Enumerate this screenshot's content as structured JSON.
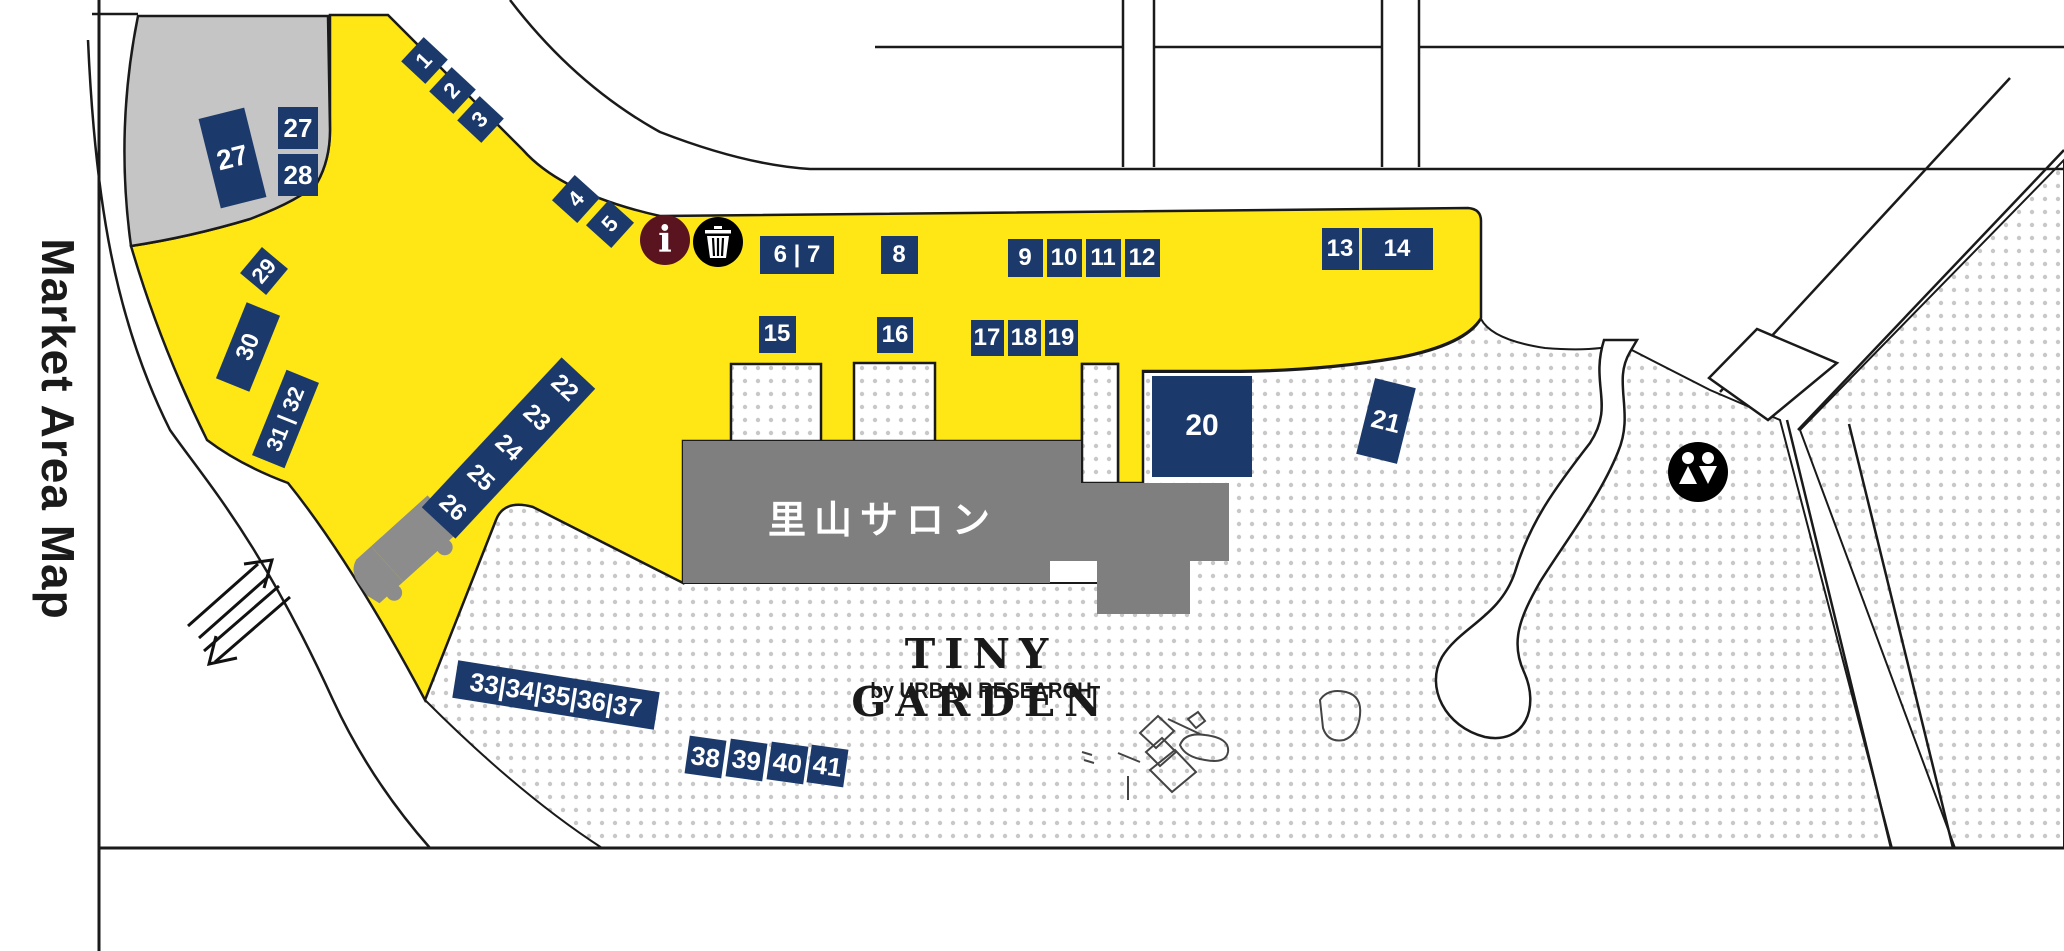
{
  "title": {
    "market_title": "Market Area Map"
  },
  "map": {
    "salon_label": "里山サロン",
    "brand": {
      "line1": "TINY GARDEN",
      "line2": "by URBAN RESEARCH"
    },
    "colors": {
      "market_yellow": "#ffe716",
      "badge_navy": "#1b3a6b",
      "parking_gray": "#c5c5c5",
      "building_gray": "#7f7f7f",
      "outline_black": "#1a1a1a",
      "dot_gray": "#c8c8c8",
      "info_maroon": "#5a1420"
    },
    "icons": {
      "info": {
        "glyph": "i",
        "x": 665,
        "y": 240,
        "r": 25
      },
      "trash": {
        "x": 718,
        "y": 242,
        "r": 25
      },
      "restroom": {
        "x": 1698,
        "y": 472,
        "r": 30
      }
    },
    "badges": [
      {
        "label": "1",
        "x": 424,
        "y": 60,
        "w": 33,
        "h": 33,
        "rot": 43,
        "trot": -90,
        "fs": 22
      },
      {
        "label": "2",
        "x": 452,
        "y": 90,
        "w": 33,
        "h": 33,
        "rot": 43,
        "trot": -90,
        "fs": 22
      },
      {
        "label": "3",
        "x": 480,
        "y": 119,
        "w": 33,
        "h": 33,
        "rot": 43,
        "trot": -90,
        "fs": 22
      },
      {
        "label": "4",
        "x": 576,
        "y": 199,
        "w": 34,
        "h": 34,
        "rot": 42,
        "trot": -90,
        "fs": 22
      },
      {
        "label": "5",
        "x": 610,
        "y": 224,
        "w": 34,
        "h": 34,
        "rot": 42,
        "trot": -90,
        "fs": 22
      },
      {
        "label": "6 | 7",
        "x": 797,
        "y": 255,
        "w": 74,
        "h": 38,
        "fs": 24
      },
      {
        "label": "8",
        "x": 899,
        "y": 255,
        "w": 37,
        "h": 38,
        "fs": 24
      },
      {
        "label": "9",
        "x": 1025,
        "y": 258,
        "w": 35,
        "h": 38,
        "fs": 24
      },
      {
        "label": "10",
        "x": 1064,
        "y": 258,
        "w": 35,
        "h": 38,
        "fs": 24
      },
      {
        "label": "11",
        "x": 1103,
        "y": 258,
        "w": 35,
        "h": 38,
        "fs": 24
      },
      {
        "label": "12",
        "x": 1142,
        "y": 258,
        "w": 35,
        "h": 38,
        "fs": 24
      },
      {
        "label": "13",
        "x": 1340,
        "y": 249,
        "w": 37,
        "h": 42,
        "fs": 24
      },
      {
        "label": "14",
        "x": 1397,
        "y": 249,
        "w": 71,
        "h": 42,
        "fs": 24
      },
      {
        "label": "15",
        "x": 777,
        "y": 334,
        "w": 37,
        "h": 37,
        "fs": 24
      },
      {
        "label": "16",
        "x": 895,
        "y": 335,
        "w": 36,
        "h": 36,
        "fs": 24
      },
      {
        "label": "17",
        "x": 987,
        "y": 338,
        "w": 33,
        "h": 36,
        "fs": 24
      },
      {
        "label": "18",
        "x": 1024,
        "y": 338,
        "w": 33,
        "h": 36,
        "fs": 24
      },
      {
        "label": "19",
        "x": 1061,
        "y": 338,
        "w": 33,
        "h": 36,
        "fs": 24
      },
      {
        "label": "20",
        "x": 1202,
        "y": 426,
        "w": 100,
        "h": 101,
        "fs": 30
      },
      {
        "label": "21",
        "x": 1386,
        "y": 421,
        "w": 42,
        "h": 78,
        "rot": 14,
        "fs": 26
      },
      {
        "parts": [
          "26",
          "25",
          "24",
          "23",
          "22"
        ],
        "x": 508,
        "y": 448,
        "w": 205,
        "h": 46,
        "rot": -47,
        "prot": 90,
        "fs": 24
      },
      {
        "label": "27",
        "x": 232,
        "y": 158,
        "w": 47,
        "h": 92,
        "rot": -14,
        "fs": 28
      },
      {
        "label": "27",
        "x": 298,
        "y": 128,
        "w": 40,
        "h": 42,
        "fs": 26
      },
      {
        "label": "28",
        "x": 298,
        "y": 175,
        "w": 40,
        "h": 42,
        "fs": 26
      },
      {
        "label": "29",
        "x": 264,
        "y": 271,
        "w": 34,
        "h": 34,
        "rot": 40,
        "trot": -90,
        "fs": 22
      },
      {
        "label": "30",
        "x": 248,
        "y": 347,
        "w": 36,
        "h": 82,
        "rot": 22,
        "trot": -90,
        "fs": 24
      },
      {
        "label": "31 | 32",
        "x": 285,
        "y": 419,
        "w": 35,
        "h": 92,
        "rot": 22,
        "trot": -90,
        "fs": 22
      },
      {
        "label": "33|34|35|36|37",
        "x": 556,
        "y": 695,
        "w": 204,
        "h": 38,
        "rot": 9,
        "fs": 26
      },
      {
        "label": "38",
        "x": 705,
        "y": 757,
        "w": 37,
        "h": 38,
        "rot": 8,
        "fs": 26
      },
      {
        "label": "39",
        "x": 746,
        "y": 760,
        "w": 37,
        "h": 38,
        "rot": 8,
        "fs": 26
      },
      {
        "label": "40",
        "x": 787,
        "y": 763,
        "w": 37,
        "h": 38,
        "rot": 8,
        "fs": 26
      },
      {
        "label": "41",
        "x": 827,
        "y": 766,
        "w": 37,
        "h": 38,
        "rot": 8,
        "fs": 26
      }
    ]
  }
}
